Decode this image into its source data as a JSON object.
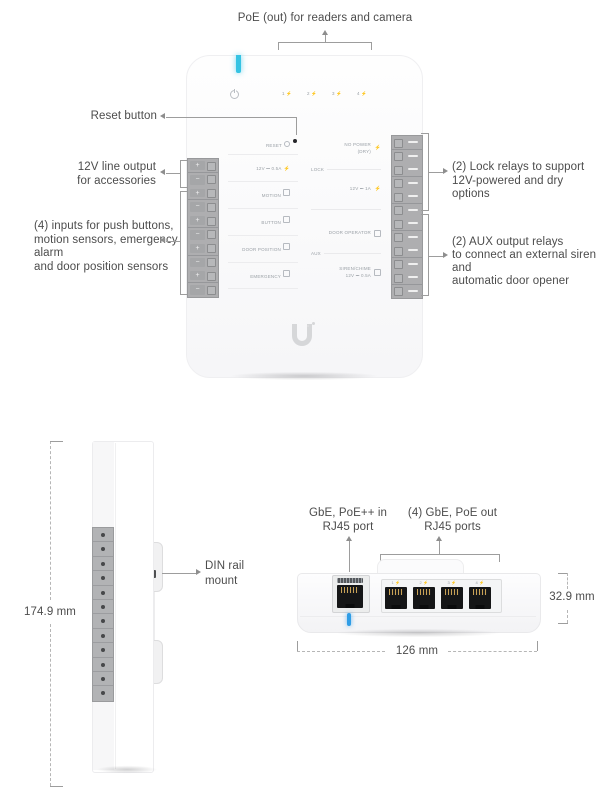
{
  "colors": {
    "led_front": "#35c3e3",
    "led_bottom": "#2f9de6"
  },
  "front_view": {
    "callouts": {
      "poe_out": "PoE (out) for readers and camera",
      "reset": "Reset button",
      "line_output": [
        "12V line output",
        "for accessories"
      ],
      "inputs": [
        "(4) inputs for push buttons,",
        "motion sensors, emergency alarm",
        "and door position sensors"
      ],
      "lock_relays": [
        "(2) Lock relays to support",
        "12V-powered and dry options"
      ],
      "aux_relays": [
        "(2) AUX output relays",
        "to connect an external siren and",
        "automatic door opener"
      ]
    },
    "panel": {
      "reset_label": "RESET",
      "top_ports": [
        "1 ⚡",
        "2 ⚡",
        "3 ⚡",
        "4 ⚡"
      ],
      "left_rows": [
        "12V ⎓ 0.5A",
        "MOTION",
        "BUTTON",
        "DOOR POSITION",
        "EMERGENCY"
      ],
      "right_top": [
        "NO POWER",
        "(DRY)"
      ],
      "sections": {
        "lock": "LOCK",
        "aux": "AUX"
      },
      "right_rows": [
        "12V ⎓ 1A",
        "DOOR OPERATOR"
      ],
      "siren": [
        "SIREN/CHIME",
        "12V ⎓ 0.5A"
      ],
      "terminal_plus": "+",
      "terminal_minus": "−"
    }
  },
  "side_view": {
    "height_label": "174.9 mm",
    "din_mount": [
      "DIN rail",
      "mount"
    ]
  },
  "bottom_view": {
    "poe_in": [
      "GbE, PoE++ in",
      "RJ45 port"
    ],
    "poe_out": [
      "(4) GbE, PoE out",
      "RJ45 ports"
    ],
    "width_label": "126 mm",
    "height_label": "32.9 mm",
    "port_labels": [
      "1 ⚡",
      "2 ⚡",
      "3 ⚡",
      "4 ⚡"
    ]
  }
}
